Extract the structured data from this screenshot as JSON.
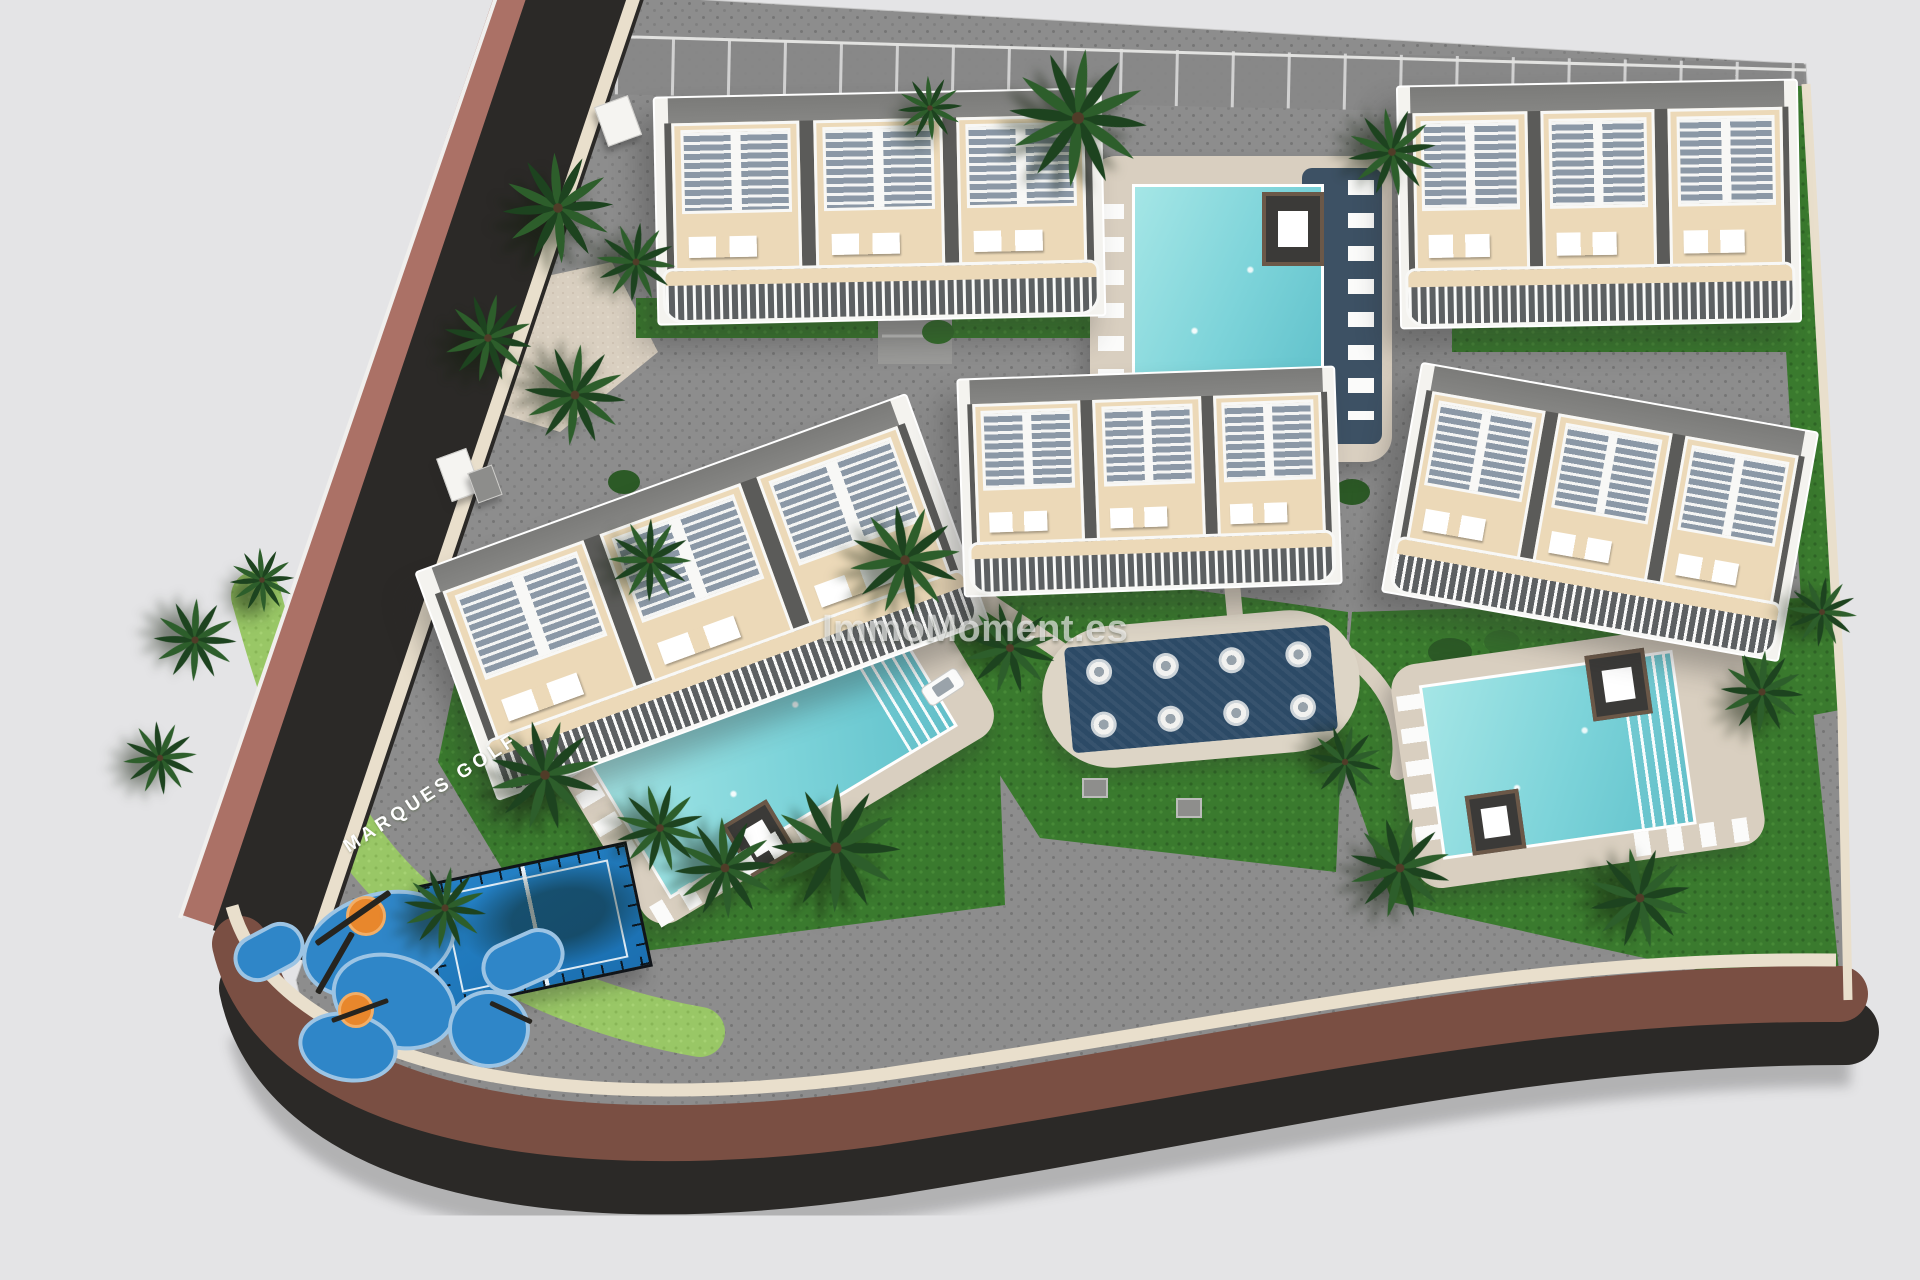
{
  "watermark": {
    "text": "ImmoMoment.es"
  },
  "road_label": {
    "text": "MARQUES GOLF"
  },
  "palette": {
    "bg": "#e4e4e6",
    "paving": "#8d8d8d",
    "asphalt": "#2b2927",
    "sidewalk": "#ab7166",
    "road_brown": "#7a4f43",
    "curb": "#e9dfcc",
    "lawn": "#3a7a2e",
    "lawn_light": "#99c766",
    "hedge": "#2c5a26",
    "pool_water": "#7cd3d9",
    "pool_deck": "#d9cfc0",
    "navy": "#2c4a66",
    "bld_white": "#f4f3ef",
    "terrace": "#ecd9b8",
    "roof_gray": "#8f8f8d",
    "padel_blue": "#2583c8",
    "play_blue": "#2f86c8",
    "play_blue_light": "#9cc4e4",
    "orange": "#e8872c",
    "palm_green": "#1d431f",
    "palm_green_2": "#2d5e2b"
  },
  "scene": {
    "type": "aerial-3d-site-plan-render",
    "buildings_count": 5,
    "swimming_pools_count": 3,
    "splash_pools_count": 1,
    "amenities": [
      "townhouse blocks with beige roof terraces and balconies",
      "communal swimming pools with sun loungers and cabanas",
      "splash pool with in-water seats",
      "padel court",
      "children playground",
      "perimeter road with sidewalks",
      "palm gardens and lawns",
      "parking row"
    ]
  }
}
